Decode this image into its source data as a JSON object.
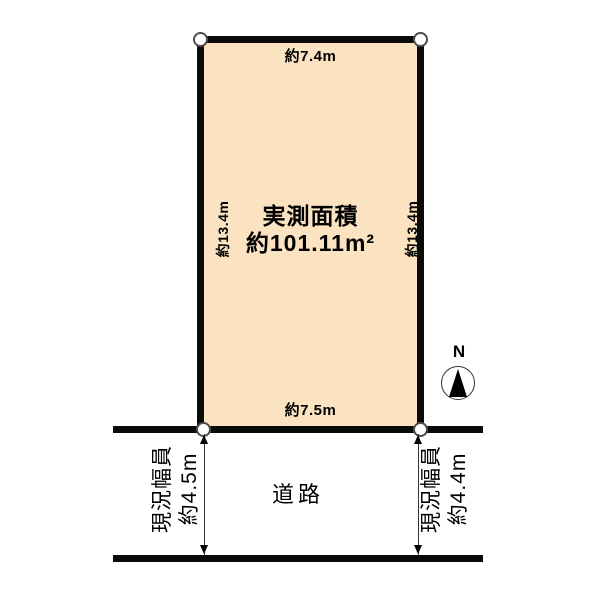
{
  "colors": {
    "plot_fill": "#FBE3C1",
    "line": "#0A0A0A",
    "marker_outline": "#4D4D4D"
  },
  "diagram": {
    "plot": {
      "area_label_line1": "実測面積",
      "area_label_line2": "約101.11m²",
      "top_dimension": "約7.4m",
      "bottom_dimension": "約7.5m",
      "left_dimension": "約13.4m",
      "right_dimension": "約13.4m"
    },
    "road": {
      "label": "道路",
      "left_width": {
        "title": "現況幅員",
        "value": "約4.5m"
      },
      "right_width": {
        "title": "現況幅員",
        "value": "約4.4m"
      }
    },
    "compass": {
      "north_label": "N"
    }
  }
}
